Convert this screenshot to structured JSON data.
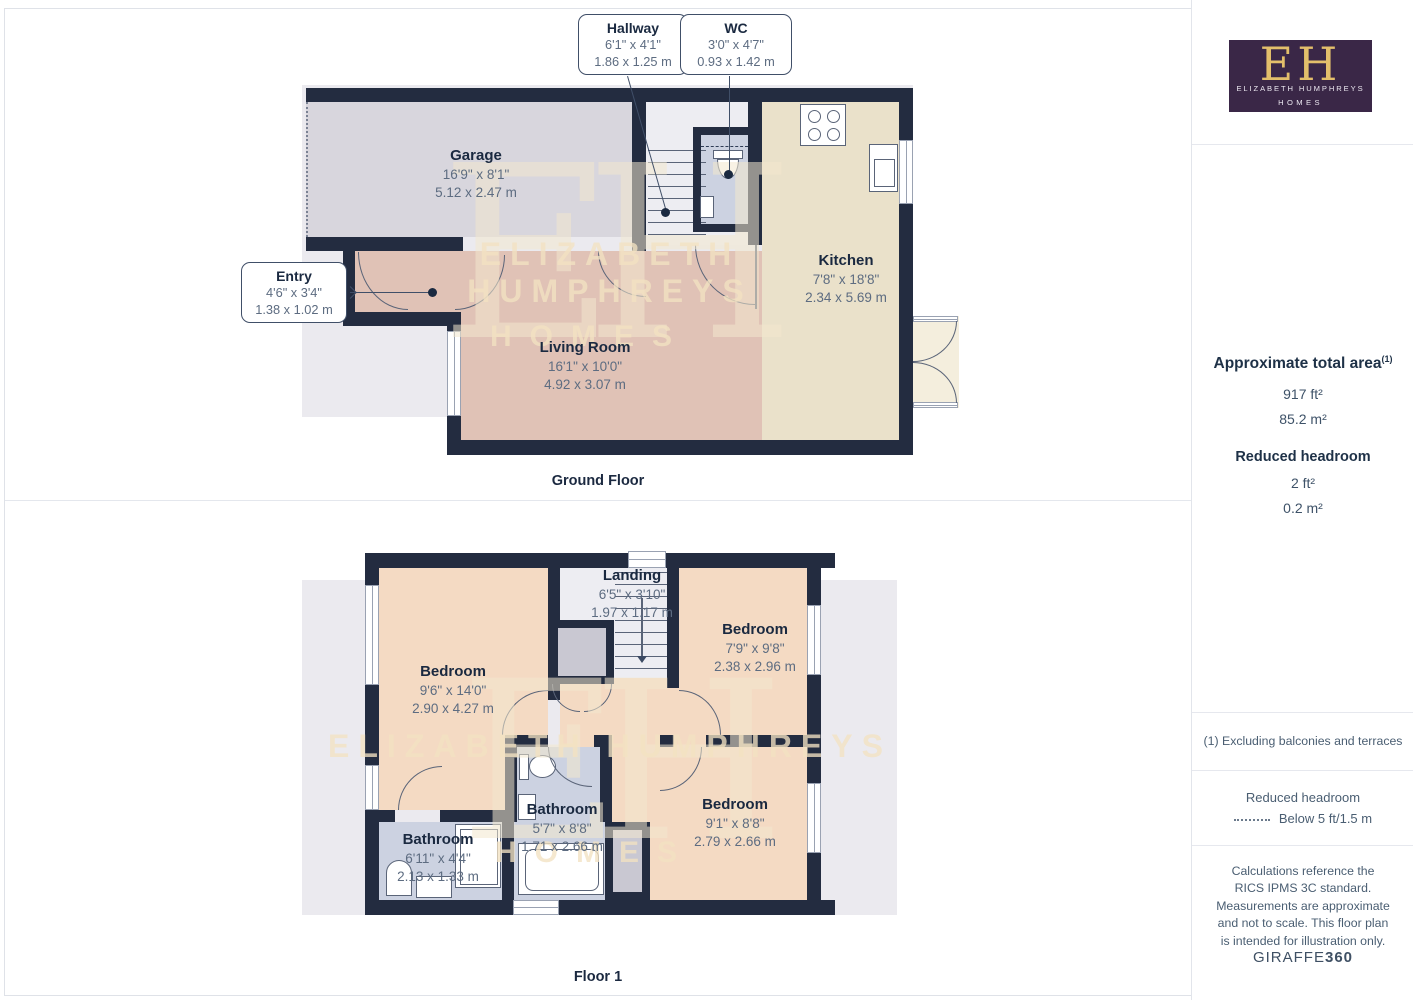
{
  "branding": {
    "monogram": "EH",
    "name": "ELIZABETH HUMPHREYS",
    "homes": "HOMES"
  },
  "watermark": {
    "monogram": "EH",
    "line1": "ELIZABETH HUMPHREYS",
    "line2": "HOMES"
  },
  "ground": {
    "caption": "Ground Floor",
    "rooms": {
      "hallway": {
        "name": "Hallway",
        "imperial": "6'1\" x 4'1\"",
        "metric": "1.86 x 1.25 m"
      },
      "wc": {
        "name": "WC",
        "imperial": "3'0\" x 4'7\"",
        "metric": "0.93 x 1.42 m"
      },
      "garage": {
        "name": "Garage",
        "imperial": "16'9\" x 8'1\"",
        "metric": "5.12 x 2.47 m"
      },
      "entry": {
        "name": "Entry",
        "imperial": "4'6\" x 3'4\"",
        "metric": "1.38 x 1.02 m"
      },
      "living_room": {
        "name": "Living Room",
        "imperial": "16'1\" x 10'0\"",
        "metric": "4.92 x 3.07 m"
      },
      "kitchen": {
        "name": "Kitchen",
        "imperial": "7'8\" x 18'8\"",
        "metric": "2.34 x 5.69 m"
      }
    }
  },
  "floor1": {
    "caption": "Floor 1",
    "rooms": {
      "landing": {
        "name": "Landing",
        "imperial": "6'5\" x 3'10\"",
        "metric": "1.97 x 1.17 m"
      },
      "bedroom1": {
        "name": "Bedroom",
        "imperial": "9'6\" x 14'0\"",
        "metric": "2.90 x 4.27 m"
      },
      "bedroom2": {
        "name": "Bedroom",
        "imperial": "7'9\" x 9'8\"",
        "metric": "2.38 x 2.96 m"
      },
      "bedroom3": {
        "name": "Bedroom",
        "imperial": "9'1\" x 8'8\"",
        "metric": "2.79 x 2.66 m"
      },
      "bathroom_main": {
        "name": "Bathroom",
        "imperial": "5'7\" x 8'8\"",
        "metric": "1.71 x 2.66 m"
      },
      "bathroom_small": {
        "name": "Bathroom",
        "imperial": "6'11\" x 4'4\"",
        "metric": "2.13 x 1.33 m"
      }
    }
  },
  "sidebar": {
    "total_area": {
      "title": "Approximate total area",
      "marker": "(1)",
      "imperial": "917 ft²",
      "metric": "85.2 m²"
    },
    "reduced_headroom": {
      "title": "Reduced headroom",
      "imperial": "2 ft²",
      "metric": "0.2 m²"
    },
    "footnote": "(1) Excluding balconies and terraces",
    "legend": {
      "title": "Reduced headroom",
      "label": "Below 5 ft/1.5 m"
    },
    "disclaimer": "Calculations reference the RICS IPMS 3C standard. Measurements are approximate and not to scale. This floor plan is intended for illustration only.",
    "provider_name": "GIRAFFE",
    "provider_suffix": "360"
  },
  "colors": {
    "wall": "#232c40",
    "bedroom_fill": "#f4dac3",
    "living_fill": "#e0c2b6",
    "kitchen_fill": "#eae1ca",
    "bathroom_fill": "#ccd2e1",
    "garage_fill": "#d8d6dd",
    "landing_fill": "#ededf2",
    "backdrop": "#ebeaef",
    "brand_purple": "#3a2747",
    "brand_gold": "#e3bf6b"
  }
}
